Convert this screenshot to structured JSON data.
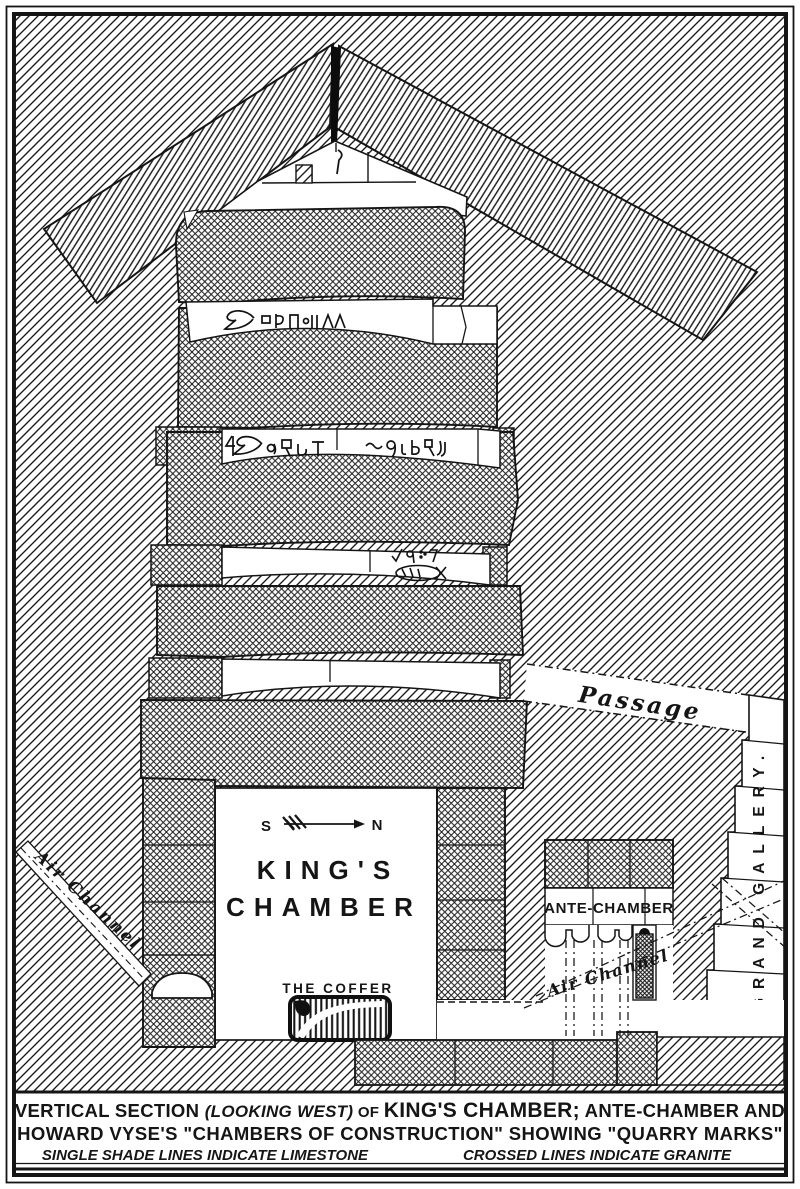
{
  "diagram": {
    "labels": {
      "passage": "Passage",
      "grand_gallery": "GRAND GALLERY.",
      "air_channel_left": "Air Channel",
      "air_channel_right": "Air Channel",
      "compass_south": "S",
      "compass_north": "N",
      "kings_chamber_line1": "KING'S",
      "kings_chamber_line2": "CHAMBER",
      "the_coffer": "THE COFFER",
      "ante_chamber": "ANTE-CHAMBER"
    },
    "icons": {
      "compass_arrow": "feathered-arrow-pointing-north-right",
      "quarry_marks": [
        "quarry-marks-row-1-bird-and-signs",
        "quarry-marks-row-2-two-cartouche-groups",
        "quarry-marks-row-3-khufu-cartouche",
        "gable-mason-mark"
      ]
    },
    "legend_semantics": {
      "limestone": "single shade lines",
      "granite": "crossed lines"
    },
    "colors": {
      "ink": "#151515",
      "paper": "#ffffff"
    }
  },
  "caption": {
    "l1a": "VERTICAL SECTION ",
    "l1b": "(LOOKING WEST)",
    "l1c": " OF ",
    "l1d": "KING'S CHAMBER;",
    "l1e": " ANTE-CHAMBER AND",
    "line2": "HOWARD VYSE'S \"CHAMBERS OF CONSTRUCTION\" SHOWING \"QUARRY MARKS\"",
    "line3_left": "SINGLE SHADE LINES INDICATE LIMESTONE",
    "line3_right": "CROSSED LINES INDICATE GRANITE"
  }
}
